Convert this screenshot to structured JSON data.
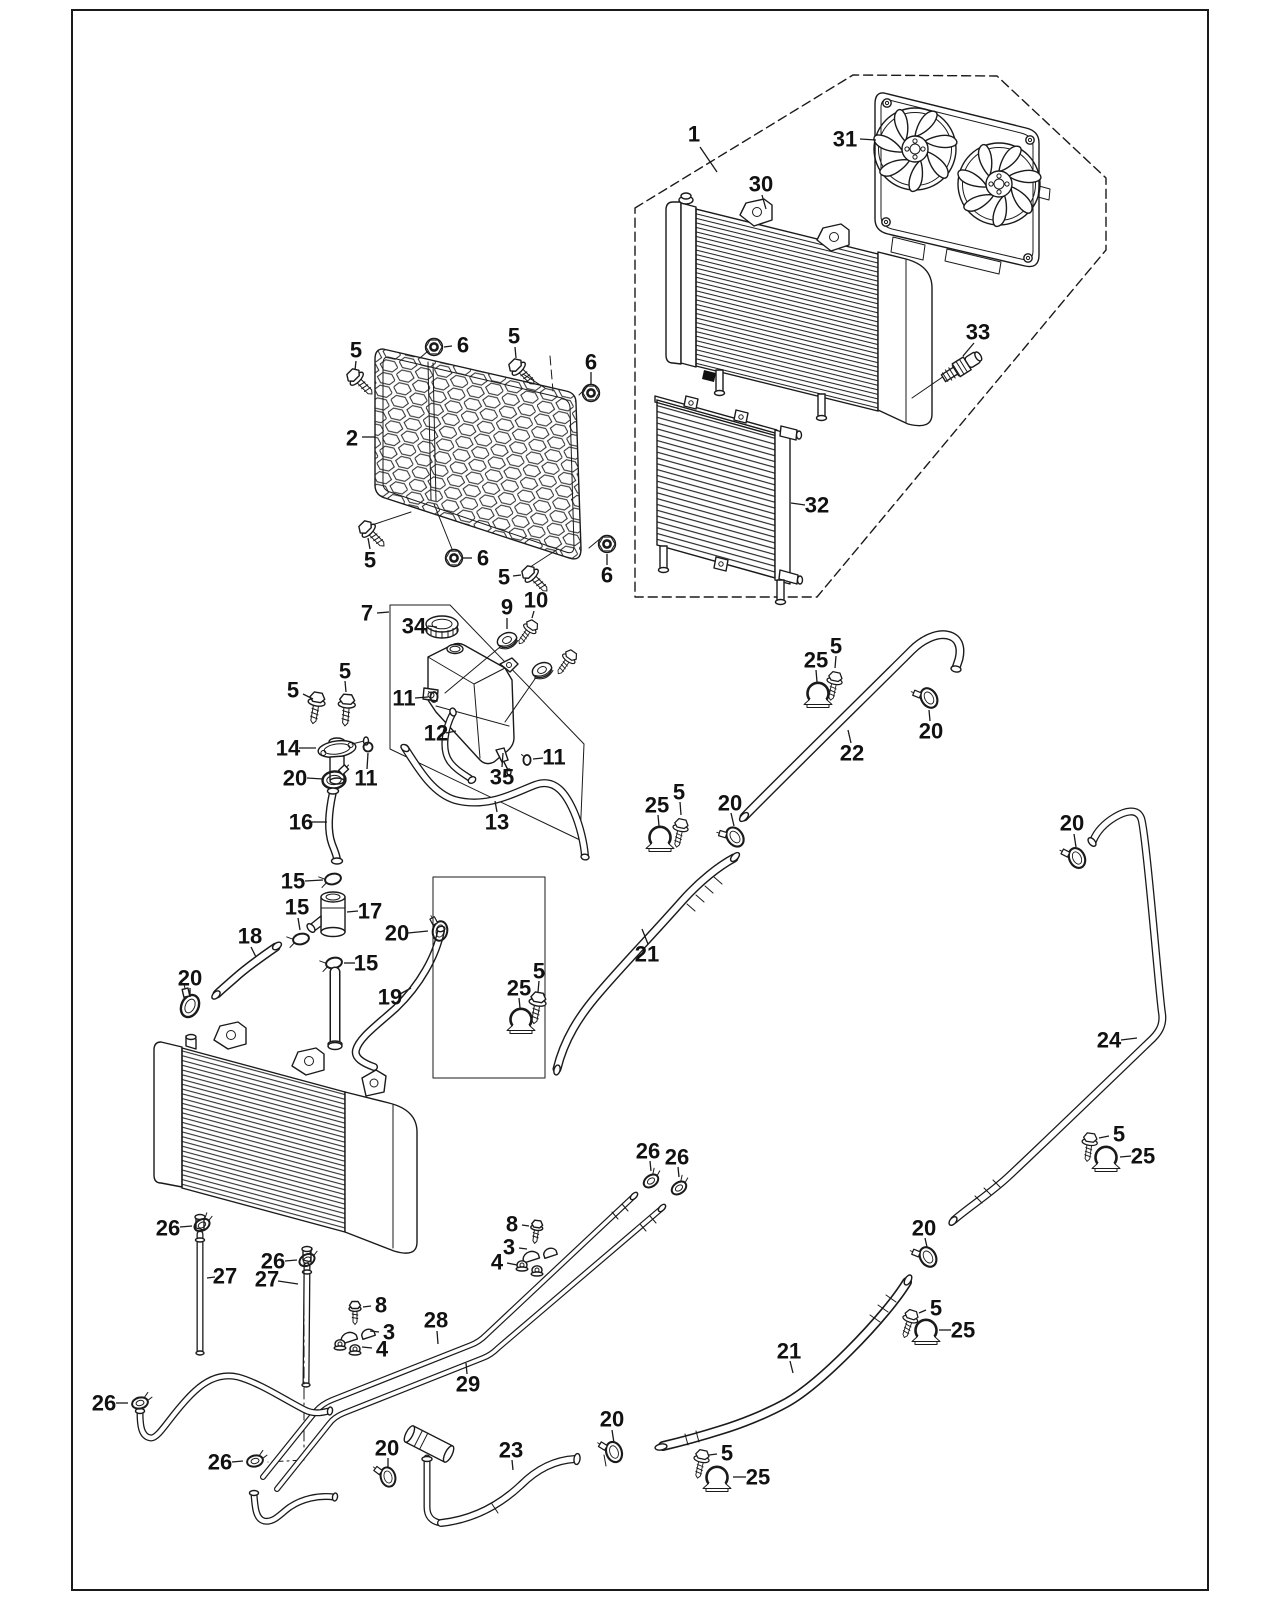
{
  "page": {
    "width": 1280,
    "height": 1600,
    "background": "#ffffff",
    "line_color": "#1a1a1a"
  },
  "figure": {
    "kind": "exploded-parts-diagram",
    "subject": "engine cooling system: radiator, fan shroud, oil cooler, reservoir tank, hoses and clamps",
    "callout_font_size": 22
  },
  "callouts": [
    {
      "ref": "1",
      "target": "fan-radiator-assembly",
      "x": 694,
      "y": 134,
      "leader": [
        [
          700,
          147
        ],
        [
          717,
          172
        ]
      ]
    },
    {
      "ref": "31",
      "target": "fan-shroud",
      "x": 845,
      "y": 139,
      "leader": [
        [
          860,
          139
        ],
        [
          876,
          140
        ]
      ]
    },
    {
      "ref": "30",
      "target": "radiator",
      "x": 761,
      "y": 184,
      "leader": [
        [
          762,
          195
        ],
        [
          766,
          209
        ]
      ]
    },
    {
      "ref": "33",
      "target": "coolant-temp-sensor",
      "x": 978,
      "y": 332,
      "leader": [
        [
          974,
          343
        ],
        [
          963,
          356
        ]
      ]
    },
    {
      "ref": "32",
      "target": "oil-cooler",
      "x": 817,
      "y": 505,
      "leader": [
        [
          805,
          505
        ],
        [
          791,
          503
        ]
      ]
    },
    {
      "ref": "2",
      "target": "radiator-mesh-guard",
      "x": 352,
      "y": 438,
      "leader": [
        [
          362,
          437
        ],
        [
          375,
          437
        ]
      ]
    },
    {
      "ref": "5",
      "target": "flange-bolt",
      "x": 356,
      "y": 350,
      "leader": [
        [
          356,
          361
        ],
        [
          355,
          370
        ]
      ]
    },
    {
      "ref": "6",
      "target": "flange-nut",
      "x": 463,
      "y": 345,
      "leader": [
        [
          452,
          346
        ],
        [
          444,
          347
        ]
      ]
    },
    {
      "ref": "5",
      "target": "flange-bolt",
      "x": 514,
      "y": 336,
      "leader": [
        [
          515,
          347
        ],
        [
          516,
          358
        ]
      ]
    },
    {
      "ref": "6",
      "target": "flange-nut",
      "x": 591,
      "y": 362,
      "leader": [
        [
          591,
          372
        ],
        [
          591,
          384
        ]
      ]
    },
    {
      "ref": "5",
      "target": "flange-bolt",
      "x": 370,
      "y": 560,
      "leader": [
        [
          370,
          549
        ],
        [
          368,
          538
        ]
      ]
    },
    {
      "ref": "6",
      "target": "flange-nut",
      "x": 483,
      "y": 558,
      "leader": [
        [
          472,
          558
        ],
        [
          463,
          558
        ]
      ]
    },
    {
      "ref": "5",
      "target": "flange-bolt",
      "x": 504,
      "y": 577,
      "leader": [
        [
          513,
          576
        ],
        [
          521,
          575
        ]
      ]
    },
    {
      "ref": "6",
      "target": "flange-nut",
      "x": 607,
      "y": 575,
      "leader": [
        [
          607,
          565
        ],
        [
          607,
          554
        ]
      ]
    },
    {
      "ref": "7",
      "target": "reservoir-assembly",
      "x": 367,
      "y": 613,
      "leader": [
        [
          377,
          613
        ],
        [
          389,
          612
        ]
      ]
    },
    {
      "ref": "34",
      "target": "reservoir-cap",
      "x": 414,
      "y": 626,
      "leader": [
        [
          428,
          626
        ],
        [
          437,
          627
        ]
      ]
    },
    {
      "ref": "9",
      "target": "grommet",
      "x": 507,
      "y": 607,
      "leader": [
        [
          507,
          618
        ],
        [
          507,
          629
        ]
      ]
    },
    {
      "ref": "10",
      "target": "grommet-bolt",
      "x": 536,
      "y": 600,
      "leader": [
        [
          534,
          611
        ],
        [
          532,
          618
        ]
      ]
    },
    {
      "ref": "11",
      "target": "clip",
      "x": 404,
      "y": 698,
      "leader": [
        [
          415,
          698
        ],
        [
          428,
          697
        ]
      ]
    },
    {
      "ref": "12",
      "target": "breather-hose",
      "x": 436,
      "y": 733,
      "leader": [
        [
          446,
          733
        ],
        [
          456,
          731
        ]
      ]
    },
    {
      "ref": "35",
      "target": "reservoir-tank",
      "x": 502,
      "y": 777,
      "leader": [
        [
          502,
          767
        ],
        [
          503,
          753
        ]
      ]
    },
    {
      "ref": "11",
      "target": "clip",
      "x": 554,
      "y": 757,
      "leader": [
        [
          543,
          758
        ],
        [
          533,
          759
        ]
      ]
    },
    {
      "ref": "13",
      "target": "overflow-hose",
      "x": 497,
      "y": 822,
      "leader": [
        [
          497,
          812
        ],
        [
          495,
          801
        ]
      ]
    },
    {
      "ref": "11",
      "target": "o-ring-clip",
      "x": 366,
      "y": 778,
      "leader": [
        [
          367,
          769
        ],
        [
          368,
          753
        ]
      ]
    },
    {
      "ref": "5",
      "target": "flange-bolt",
      "x": 293,
      "y": 690,
      "leader": [
        [
          303,
          694
        ],
        [
          313,
          699
        ]
      ]
    },
    {
      "ref": "5",
      "target": "flange-bolt",
      "x": 345,
      "y": 671,
      "leader": [
        [
          345,
          681
        ],
        [
          346,
          692
        ]
      ]
    },
    {
      "ref": "14",
      "target": "filler-neck",
      "x": 288,
      "y": 748,
      "leader": [
        [
          299,
          748
        ],
        [
          316,
          748
        ]
      ]
    },
    {
      "ref": "20",
      "target": "hose-clamp",
      "x": 295,
      "y": 778,
      "leader": [
        [
          307,
          778
        ],
        [
          323,
          779
        ]
      ]
    },
    {
      "ref": "16",
      "target": "filler-hose",
      "x": 301,
      "y": 822,
      "leader": [
        [
          312,
          822
        ],
        [
          327,
          822
        ]
      ]
    },
    {
      "ref": "15",
      "target": "spring-clamp",
      "x": 293,
      "y": 881,
      "leader": [
        [
          305,
          881
        ],
        [
          323,
          880
        ]
      ]
    },
    {
      "ref": "17",
      "target": "thermostat-tee",
      "x": 370,
      "y": 911,
      "leader": [
        [
          358,
          911
        ],
        [
          347,
          912
        ]
      ]
    },
    {
      "ref": "15",
      "target": "spring-clamp",
      "x": 297,
      "y": 907,
      "leader": [
        [
          298,
          918
        ],
        [
          300,
          930
        ]
      ]
    },
    {
      "ref": "15",
      "target": "spring-clamp",
      "x": 366,
      "y": 963,
      "leader": [
        [
          355,
          963
        ],
        [
          344,
          963
        ]
      ]
    },
    {
      "ref": "18",
      "target": "upper-radiator-hose",
      "x": 250,
      "y": 936,
      "leader": [
        [
          251,
          947
        ],
        [
          256,
          957
        ]
      ]
    },
    {
      "ref": "20",
      "target": "hose-clamp",
      "x": 190,
      "y": 978,
      "leader": [
        [
          190,
          988
        ],
        [
          190,
          997
        ]
      ]
    },
    {
      "ref": "19",
      "target": "inlet-hose",
      "x": 390,
      "y": 997,
      "leader": [
        [
          400,
          994
        ],
        [
          411,
          988
        ]
      ]
    },
    {
      "ref": "20",
      "target": "hose-clamp",
      "x": 397,
      "y": 933,
      "leader": [
        [
          408,
          933
        ],
        [
          428,
          931
        ]
      ]
    },
    {
      "ref": "25",
      "target": "pipe-mount-clamp",
      "x": 519,
      "y": 988,
      "leader": [
        [
          519,
          998
        ],
        [
          520,
          1008
        ]
      ]
    },
    {
      "ref": "5",
      "target": "flange-bolt",
      "x": 539,
      "y": 971,
      "leader": [
        [
          539,
          981
        ],
        [
          538,
          992
        ]
      ]
    },
    {
      "ref": "21",
      "target": "water-pipe",
      "x": 647,
      "y": 954,
      "leader": [
        [
          648,
          944
        ],
        [
          642,
          929
        ]
      ]
    },
    {
      "ref": "25",
      "target": "pipe-mount-clamp",
      "x": 657,
      "y": 805,
      "leader": [
        [
          658,
          815
        ],
        [
          659,
          826
        ]
      ]
    },
    {
      "ref": "5",
      "target": "flange-bolt",
      "x": 679,
      "y": 792,
      "leader": [
        [
          680,
          802
        ],
        [
          681,
          815
        ]
      ]
    },
    {
      "ref": "20",
      "target": "hose-clamp",
      "x": 730,
      "y": 803,
      "leader": [
        [
          731,
          813
        ],
        [
          734,
          826
        ]
      ]
    },
    {
      "ref": "22",
      "target": "water-pipe",
      "x": 852,
      "y": 753,
      "leader": [
        [
          851,
          743
        ],
        [
          848,
          730
        ]
      ]
    },
    {
      "ref": "25",
      "target": "pipe-mount-clamp",
      "x": 816,
      "y": 660,
      "leader": [
        [
          816,
          670
        ],
        [
          817,
          682
        ]
      ]
    },
    {
      "ref": "5",
      "target": "flange-bolt",
      "x": 836,
      "y": 646,
      "leader": [
        [
          836,
          656
        ],
        [
          835,
          668
        ]
      ]
    },
    {
      "ref": "20",
      "target": "hose-clamp",
      "x": 931,
      "y": 731,
      "leader": [
        [
          930,
          721
        ],
        [
          929,
          710
        ]
      ]
    },
    {
      "ref": "20",
      "target": "hose-clamp",
      "x": 1072,
      "y": 823,
      "leader": [
        [
          1074,
          834
        ],
        [
          1076,
          847
        ]
      ]
    },
    {
      "ref": "24",
      "target": "water-pipe",
      "x": 1109,
      "y": 1040,
      "leader": [
        [
          1121,
          1040
        ],
        [
          1137,
          1038
        ]
      ]
    },
    {
      "ref": "5",
      "target": "flange-bolt",
      "x": 1119,
      "y": 1134,
      "leader": [
        [
          1109,
          1136
        ],
        [
          1099,
          1138
        ]
      ]
    },
    {
      "ref": "25",
      "target": "pipe-mount-clamp",
      "x": 1143,
      "y": 1156,
      "leader": [
        [
          1131,
          1156
        ],
        [
          1120,
          1157
        ]
      ]
    },
    {
      "ref": "20",
      "target": "hose-clamp",
      "x": 924,
      "y": 1228,
      "leader": [
        [
          925,
          1238
        ],
        [
          927,
          1247
        ]
      ]
    },
    {
      "ref": "21",
      "target": "water-pipe",
      "x": 789,
      "y": 1351,
      "leader": [
        [
          790,
          1361
        ],
        [
          793,
          1373
        ]
      ]
    },
    {
      "ref": "5",
      "target": "flange-bolt",
      "x": 936,
      "y": 1308,
      "leader": [
        [
          926,
          1310
        ],
        [
          919,
          1313
        ]
      ]
    },
    {
      "ref": "25",
      "target": "pipe-mount-clamp",
      "x": 963,
      "y": 1330,
      "leader": [
        [
          951,
          1330
        ],
        [
          939,
          1330
        ]
      ]
    },
    {
      "ref": "5",
      "target": "flange-bolt",
      "x": 727,
      "y": 1453,
      "leader": [
        [
          717,
          1454
        ],
        [
          709,
          1455
        ]
      ]
    },
    {
      "ref": "25",
      "target": "pipe-mount-clamp",
      "x": 758,
      "y": 1477,
      "leader": [
        [
          746,
          1477
        ],
        [
          733,
          1477
        ]
      ]
    },
    {
      "ref": "20",
      "target": "hose-clamp",
      "x": 612,
      "y": 1419,
      "leader": [
        [
          612,
          1430
        ],
        [
          614,
          1443
        ]
      ]
    },
    {
      "ref": "26",
      "target": "spring-clamp",
      "x": 168,
      "y": 1228,
      "leader": [
        [
          180,
          1227
        ],
        [
          192,
          1226
        ]
      ]
    },
    {
      "ref": "26",
      "target": "spring-clamp",
      "x": 273,
      "y": 1261,
      "leader": [
        [
          285,
          1261
        ],
        [
          297,
          1260
        ]
      ]
    },
    {
      "ref": "27",
      "target": "drain-tube",
      "x": 225,
      "y": 1276,
      "leader": [
        [
          215,
          1277
        ],
        [
          207,
          1278
        ]
      ]
    },
    {
      "ref": "27",
      "target": "drain-tube",
      "x": 267,
      "y": 1279,
      "leader": [
        [
          278,
          1281
        ],
        [
          298,
          1284
        ]
      ]
    },
    {
      "ref": "8",
      "target": "screw",
      "x": 381,
      "y": 1305,
      "leader": [
        [
          371,
          1306
        ],
        [
          363,
          1307
        ]
      ]
    },
    {
      "ref": "3",
      "target": "pipe-bracket",
      "x": 389,
      "y": 1332,
      "leader": [
        [
          379,
          1332
        ],
        [
          370,
          1331
        ]
      ]
    },
    {
      "ref": "4",
      "target": "flange-nut",
      "x": 382,
      "y": 1349,
      "leader": [
        [
          372,
          1348
        ],
        [
          362,
          1347
        ]
      ]
    },
    {
      "ref": "28",
      "target": "metal-pipe",
      "x": 436,
      "y": 1320,
      "leader": [
        [
          437,
          1331
        ],
        [
          438,
          1344
        ]
      ]
    },
    {
      "ref": "29",
      "target": "metal-pipe",
      "x": 468,
      "y": 1384,
      "leader": [
        [
          467,
          1374
        ],
        [
          466,
          1363
        ]
      ]
    },
    {
      "ref": "8",
      "target": "screw",
      "x": 512,
      "y": 1224,
      "leader": [
        [
          522,
          1225
        ],
        [
          529,
          1226
        ]
      ]
    },
    {
      "ref": "3",
      "target": "pipe-bracket",
      "x": 509,
      "y": 1247,
      "leader": [
        [
          519,
          1248
        ],
        [
          527,
          1249
        ]
      ]
    },
    {
      "ref": "4",
      "target": "flange-nut",
      "x": 497,
      "y": 1262,
      "leader": [
        [
          507,
          1263
        ],
        [
          517,
          1265
        ]
      ]
    },
    {
      "ref": "26",
      "target": "spring-clamp",
      "x": 648,
      "y": 1151,
      "leader": [
        [
          650,
          1161
        ],
        [
          651,
          1171
        ]
      ]
    },
    {
      "ref": "26",
      "target": "spring-clamp",
      "x": 677,
      "y": 1157,
      "leader": [
        [
          678,
          1167
        ],
        [
          679,
          1177
        ]
      ]
    },
    {
      "ref": "26",
      "target": "spring-clamp",
      "x": 104,
      "y": 1403,
      "leader": [
        [
          116,
          1403
        ],
        [
          128,
          1403
        ]
      ]
    },
    {
      "ref": "26",
      "target": "spring-clamp",
      "x": 220,
      "y": 1462,
      "leader": [
        [
          232,
          1462
        ],
        [
          243,
          1461
        ]
      ]
    },
    {
      "ref": "20",
      "target": "hose-clamp",
      "x": 387,
      "y": 1448,
      "leader": [
        [
          388,
          1458
        ],
        [
          388,
          1467
        ]
      ]
    },
    {
      "ref": "23",
      "target": "bypass-hose",
      "x": 511,
      "y": 1450,
      "leader": [
        [
          512,
          1460
        ],
        [
          513,
          1470
        ]
      ]
    }
  ]
}
